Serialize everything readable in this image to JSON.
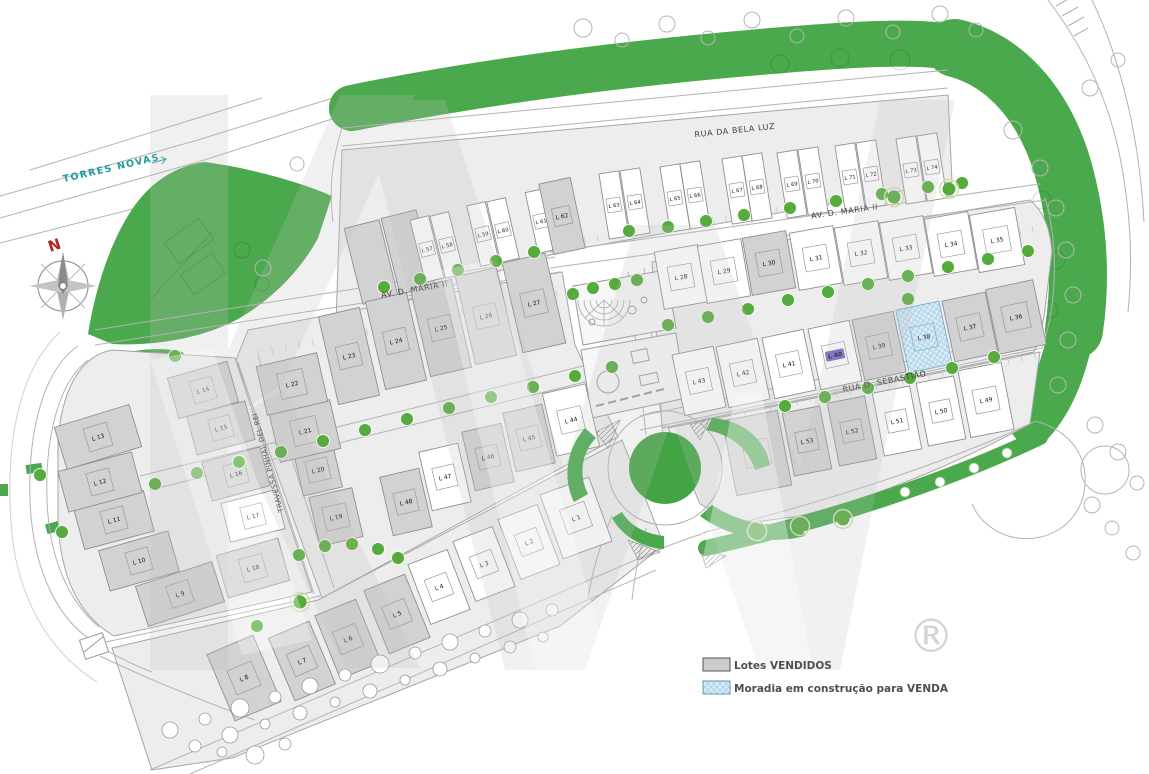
{
  "legend": {
    "items": [
      {
        "key": "sold",
        "label": "Lotes VENDIDOS"
      },
      {
        "key": "construction",
        "label": "Moradia em construção para VENDA"
      }
    ]
  },
  "streets": [
    {
      "name": "RUA DA BELA LUZ"
    },
    {
      "name": "AV. D. MARIA II"
    },
    {
      "name": "AV. D. MARIA II"
    },
    {
      "name": "RUA D. SEBASTIÃO"
    },
    {
      "name": "TRAVESSA PINHAL DEL REI"
    },
    {
      "name": "TORRES NOVAS"
    }
  ],
  "compass": {
    "north_label": "N"
  },
  "watermark": {
    "registered_symbol": "®"
  },
  "colors": {
    "green": "#4aa94d",
    "sold_fill": "#d2d2d2",
    "available_fill": "#ffffff",
    "construction_fill": "#d9ecf7",
    "tree": "#55ab3b",
    "highlight_purple": "#7a5fc7",
    "north_red": "#b42222",
    "torres_teal": "#1a9c9c"
  },
  "lots": [
    {
      "id": "L 1",
      "status": "available"
    },
    {
      "id": "L 2",
      "status": "available"
    },
    {
      "id": "L 3",
      "status": "available"
    },
    {
      "id": "L 4",
      "status": "available"
    },
    {
      "id": "L 5",
      "status": "sold"
    },
    {
      "id": "L 6",
      "status": "sold"
    },
    {
      "id": "L 7",
      "status": "sold"
    },
    {
      "id": "L 8",
      "status": "sold"
    },
    {
      "id": "L 9",
      "status": "sold"
    },
    {
      "id": "L 10",
      "status": "sold"
    },
    {
      "id": "L 11",
      "status": "sold"
    },
    {
      "id": "L 12",
      "status": "sold"
    },
    {
      "id": "L 13",
      "status": "sold"
    },
    {
      "id": "L 14",
      "status": "sold"
    },
    {
      "id": "L 15",
      "status": "sold"
    },
    {
      "id": "L 16",
      "status": "sold"
    },
    {
      "id": "L 17",
      "status": "available"
    },
    {
      "id": "L 18",
      "status": "sold"
    },
    {
      "id": "L 19",
      "status": "sold"
    },
    {
      "id": "L 20",
      "status": "sold"
    },
    {
      "id": "L 21",
      "status": "sold"
    },
    {
      "id": "L 22",
      "status": "sold"
    },
    {
      "id": "L 23",
      "status": "sold"
    },
    {
      "id": "L 24",
      "status": "sold"
    },
    {
      "id": "L 25",
      "status": "sold"
    },
    {
      "id": "L 26",
      "status": "sold"
    },
    {
      "id": "L 27",
      "status": "sold"
    },
    {
      "id": "L 28",
      "status": "available"
    },
    {
      "id": "L 29",
      "status": "available"
    },
    {
      "id": "L 30",
      "status": "sold"
    },
    {
      "id": "L 31",
      "status": "available"
    },
    {
      "id": "L 32",
      "status": "available"
    },
    {
      "id": "L 33",
      "status": "available"
    },
    {
      "id": "L 34",
      "status": "available"
    },
    {
      "id": "L 35",
      "status": "available"
    },
    {
      "id": "L 36",
      "status": "sold"
    },
    {
      "id": "L 37",
      "status": "sold"
    },
    {
      "id": "L 38",
      "status": "construction"
    },
    {
      "id": "L 39",
      "status": "sold"
    },
    {
      "id": "L 40",
      "status": "available",
      "highlight": true
    },
    {
      "id": "L 41",
      "status": "available"
    },
    {
      "id": "L 42",
      "status": "available"
    },
    {
      "id": "L 43",
      "status": "available"
    },
    {
      "id": "L 44",
      "status": "available"
    },
    {
      "id": "L 45",
      "status": "sold"
    },
    {
      "id": "L 46",
      "status": "sold"
    },
    {
      "id": "L 47",
      "status": "available"
    },
    {
      "id": "L 48",
      "status": "sold"
    },
    {
      "id": "L 49",
      "status": "available"
    },
    {
      "id": "L 50",
      "status": "available"
    },
    {
      "id": "L 51",
      "status": "available"
    },
    {
      "id": "L 52",
      "status": "sold"
    },
    {
      "id": "L 53",
      "status": "sold"
    },
    {
      "id": "L 54",
      "status": "sold"
    },
    {
      "id": "L 57",
      "status": "available"
    },
    {
      "id": "L 58",
      "status": "available"
    },
    {
      "id": "L 59",
      "status": "available"
    },
    {
      "id": "L 60",
      "status": "available"
    },
    {
      "id": "L 61",
      "status": "available"
    },
    {
      "id": "L 62",
      "status": "sold"
    },
    {
      "id": "L 63",
      "status": "available"
    },
    {
      "id": "L 64",
      "status": "available"
    },
    {
      "id": "L 65",
      "status": "available"
    },
    {
      "id": "L 66",
      "status": "available"
    },
    {
      "id": "L 67",
      "status": "available"
    },
    {
      "id": "L 68",
      "status": "available"
    },
    {
      "id": "L 69",
      "status": "available"
    },
    {
      "id": "L 70",
      "status": "available"
    },
    {
      "id": "L 71",
      "status": "available"
    },
    {
      "id": "L 72",
      "status": "available"
    },
    {
      "id": "L 73",
      "status": "available"
    },
    {
      "id": "L 74",
      "status": "available"
    }
  ]
}
